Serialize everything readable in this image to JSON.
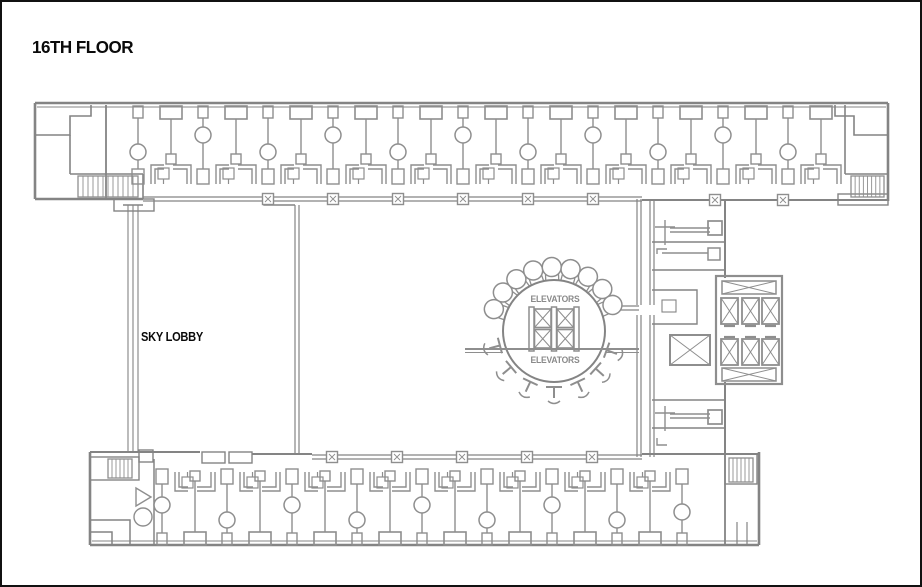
{
  "title": "16TH FLOOR",
  "labels": {
    "sky_lobby": "SKY LOBBY",
    "elevators_top": "ELEVATORS",
    "elevators_bottom": "ELEVATORS"
  },
  "colors": {
    "background": "#ffffff",
    "border": "#111111",
    "wall": "#848484",
    "fixture": "#8e8e8e",
    "title_text": "#0a0a0a",
    "label_text": "#0a0a0a",
    "elevator_text": "#8a8a8a"
  },
  "plan": {
    "top_wing": {
      "bays": 11,
      "bay_width": 65,
      "start_x": 136,
      "columns_x": [
        266,
        331,
        396,
        461,
        526,
        591
      ]
    },
    "bottom_wing": {
      "bays": 8,
      "bay_width": 65,
      "start_x": 160,
      "extra_partition_x": 680,
      "columns_x": [
        330,
        395,
        460,
        525,
        590
      ]
    },
    "central_core": {
      "cx": 552,
      "cy": 329,
      "radius": 51,
      "elevator_cells": 4,
      "bulb_chair_angles": [
        160,
        143,
        126,
        109,
        92,
        75,
        58,
        41,
        24
      ],
      "tee_chair_angles": [
        195,
        220,
        245,
        270,
        295,
        318,
        340
      ]
    },
    "right_core": {
      "elevator_cells": 6
    },
    "stairwells": 4
  }
}
